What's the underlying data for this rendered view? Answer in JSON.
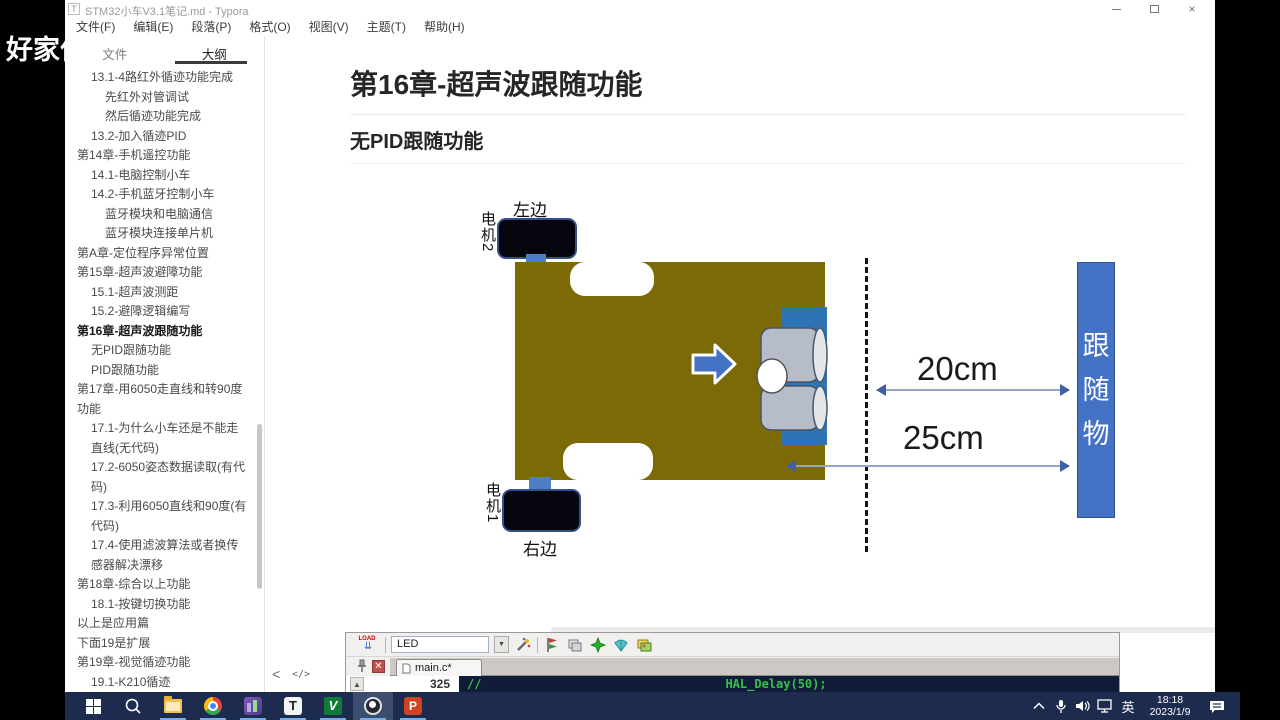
{
  "watermark": "好家伙",
  "titlebar": {
    "app_letter": "T",
    "title": "STM32小车V3.1笔记.md - Typora"
  },
  "menu": {
    "items": [
      "文件(F)",
      "编辑(E)",
      "段落(P)",
      "格式(O)",
      "视图(V)",
      "主题(T)",
      "帮助(H)"
    ]
  },
  "sidebar": {
    "tabs": [
      {
        "label": "文件",
        "active": false
      },
      {
        "label": "大纲",
        "active": true
      }
    ],
    "outline": [
      {
        "text": "13.1-4路红外循迹功能完成",
        "level": 2
      },
      {
        "text": "先红外对管调试",
        "level": 3
      },
      {
        "text": "然后循迹功能完成",
        "level": 3
      },
      {
        "text": "13.2-加入循迹PID",
        "level": 2
      },
      {
        "text": "第14章-手机遥控功能",
        "level": 1
      },
      {
        "text": "14.1-电脑控制小车",
        "level": 2
      },
      {
        "text": "14.2-手机蓝牙控制小车",
        "level": 2
      },
      {
        "text": "蓝牙模块和电脑通信",
        "level": 3
      },
      {
        "text": "蓝牙模块连接单片机",
        "level": 3
      },
      {
        "text": "第A章-定位程序异常位置",
        "level": 1
      },
      {
        "text": "第15章-超声波避障功能",
        "level": 1
      },
      {
        "text": "15.1-超声波测距",
        "level": 2
      },
      {
        "text": "15.2-避障逻辑编写",
        "level": 2
      },
      {
        "text": "第16章-超声波跟随功能",
        "level": 1,
        "bold": true
      },
      {
        "text": "无PID跟随功能",
        "level": 2
      },
      {
        "text": "PID跟随功能",
        "level": 2
      },
      {
        "text": "第17章-用6050走直线和转90度功能",
        "level": 1
      },
      {
        "text": "17.1-为什么小车还是不能走直线(无代码)",
        "level": 2
      },
      {
        "text": "17.2-6050姿态数据读取(有代码)",
        "level": 2
      },
      {
        "text": "17.3-利用6050直线和90度(有代码)",
        "level": 2
      },
      {
        "text": "17.4-使用滤波算法或者换传感器解决漂移",
        "level": 2
      },
      {
        "text": "第18章-综合以上功能",
        "level": 1
      },
      {
        "text": "18.1-按键切换功能",
        "level": 2
      },
      {
        "text": "以上是应用篇",
        "level": 1
      },
      {
        "text": "下面19是扩展",
        "level": 1
      },
      {
        "text": "第19章-视觉循迹功能",
        "level": 1
      },
      {
        "text": "19.1-K210循迹",
        "level": 2
      }
    ],
    "footer": {
      "collapse": "<",
      "source_mode": "</>"
    }
  },
  "content": {
    "h1": "第16章-超声波跟随功能",
    "h2": "无PID跟随功能",
    "word_count": "23678 词"
  },
  "diagram": {
    "label_top": "左边",
    "motor_top": "电机2",
    "motor_bottom": "电机1",
    "label_bottom": "右边",
    "dist_near": "20cm",
    "dist_far": "25cm",
    "target": {
      "char1": "跟",
      "char2": "随",
      "char3": "物"
    }
  },
  "keil": {
    "load_label": "LOAD",
    "target_name": "LED",
    "dropdown_glyph": "▼",
    "tab": "main.c*",
    "line_number": "325",
    "comment": "//",
    "code": "HAL_Delay(50);",
    "scroll_up_glyph": "▲"
  },
  "taskbar": {
    "ime": "英",
    "time": "18:18",
    "date": "2023/1/9",
    "logos": {
      "typora": "T",
      "keil": "V",
      "powerpoint": "P"
    }
  },
  "colors": {
    "car_body": "#7b6a06",
    "accent_blue": "#4472c4",
    "taskbar_bg": "#1d2b4e",
    "code_green": "#35c24a",
    "keil_close_red": "#c0504d"
  }
}
